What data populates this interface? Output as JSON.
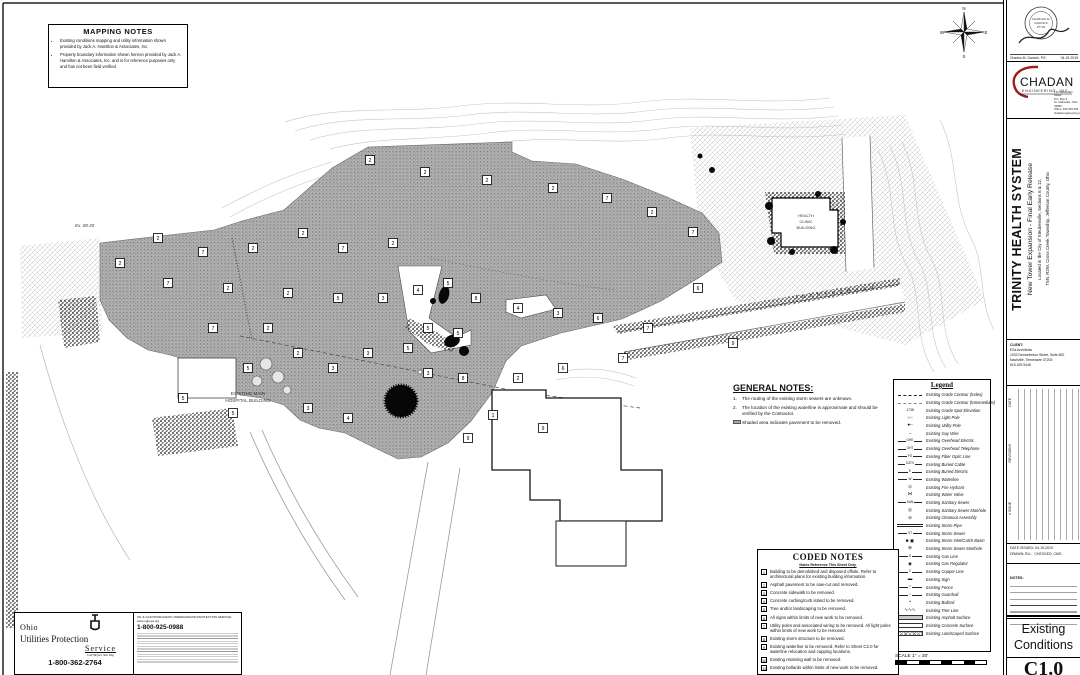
{
  "mapping_notes": {
    "title": "MAPPING NOTES",
    "items": [
      "Existing conditions mapping and utility information shown provided by Jack A. Hamilton & Associates, Inc.",
      "Property boundary information shown hereon provided by Jack A. Hamilton & Associates, Inc. and is for reference purposes only and has not been field verified."
    ]
  },
  "general_notes": {
    "title": "GENERAL NOTES:",
    "items": [
      "The routing of the existing storm sewers are unknown.",
      "The location of the existing waterline is approximate and should be verified by the Contractor."
    ],
    "shaded_note": "Shaded area indicates pavement to be removed."
  },
  "coded_notes": {
    "title": "CODED NOTES",
    "subtitle": "Notes Reference This Sheet Only.",
    "items": [
      {
        "n": "1",
        "t": "Building to be demolished and disposed offsite.  Refer to architectural plans for existing building information."
      },
      {
        "n": "2",
        "t": "Asphalt pavement to be saw-cut and removed."
      },
      {
        "n": "3",
        "t": "Concrete sidewalk to be removed."
      },
      {
        "n": "4",
        "t": "Concrete curbing/curb island to be removed."
      },
      {
        "n": "5",
        "t": "Tree and/or landscaping to be removed."
      },
      {
        "n": "6",
        "t": "All signs within limits of new work to be removed."
      },
      {
        "n": "7",
        "t": "Utility poles and associated wiring to be removed. All light poles within limits of new work to be removed."
      },
      {
        "n": "8",
        "t": "Existing storm structure to be removed."
      },
      {
        "n": "9",
        "t": "Existing waterline to be removed.  Refer to Sheet C2.0 for waterline relocation and capping locations."
      },
      {
        "n": "10",
        "t": "Existing retaining wall to be removed."
      },
      {
        "n": "11",
        "t": "Existing bollards within limits of new work to be removed."
      }
    ]
  },
  "legend": {
    "title": "Legend",
    "items": [
      {
        "k": "dash",
        "t": "Existing Grade Contour (Index)"
      },
      {
        "k": "dash2",
        "t": "Existing Grade Contour (Intermediate)"
      },
      {
        "k": "spot",
        "g": "1738",
        "t": "Existing Grade Spot Elevation"
      },
      {
        "k": "glyph",
        "g": "○–",
        "t": "Existing Light Pole"
      },
      {
        "k": "glyph",
        "g": "●–",
        "t": "Existing Utility Pole"
      },
      {
        "k": "glyph",
        "g": "→",
        "t": "Existing Guy Wire"
      },
      {
        "k": "line",
        "g": "OHE",
        "t": "Existing Overhead Electric"
      },
      {
        "k": "line",
        "g": "OHT",
        "t": "Existing Overhead Telephone"
      },
      {
        "k": "line",
        "g": "FO",
        "t": "Existing Fiber Optic Line"
      },
      {
        "k": "line",
        "g": "CATV",
        "t": "Existing Buried Cable"
      },
      {
        "k": "line",
        "g": "E",
        "t": "Existing Buried Electric"
      },
      {
        "k": "line",
        "g": "W",
        "t": "Existing Waterline"
      },
      {
        "k": "glyph",
        "g": "⊙",
        "t": "Existing Fire Hydrant"
      },
      {
        "k": "glyph",
        "g": "⋈",
        "t": "Existing Water Valve"
      },
      {
        "k": "line",
        "g": "SAN",
        "t": "Existing Sanitary Sewer"
      },
      {
        "k": "glyph",
        "g": "◎",
        "t": "Existing Sanitary Sewer Manhole"
      },
      {
        "k": "glyph",
        "g": "⊘",
        "t": "Existing Cleanout Assembly"
      },
      {
        "k": "dbl",
        "t": "Existing Storm Pipe"
      },
      {
        "k": "line",
        "g": "ST",
        "t": "Existing Storm Sewer"
      },
      {
        "k": "glyph",
        "g": "■ ▣",
        "t": "Existing Storm Inlet/Catch Basin"
      },
      {
        "k": "glyph",
        "g": "⊕",
        "t": "Existing Storm Sewer Manhole"
      },
      {
        "k": "line",
        "g": "G",
        "t": "Existing Gas Line"
      },
      {
        "k": "glyph",
        "g": "◉",
        "t": "Existing Gas Regulator"
      },
      {
        "k": "line",
        "g": "C",
        "t": "Existing Copper Line"
      },
      {
        "k": "glyph",
        "g": "▬",
        "t": "Existing Sign"
      },
      {
        "k": "line",
        "g": "×",
        "t": "Existing Fence"
      },
      {
        "k": "line",
        "g": "•",
        "t": "Existing Guardrail"
      },
      {
        "k": "glyph",
        "g": "•",
        "t": "Existing Bollard"
      },
      {
        "k": "glyph",
        "g": "∿∿∿",
        "t": "Existing Tree Line"
      },
      {
        "k": "swatch-a",
        "t": "Existing Asphalt Surface"
      },
      {
        "k": "swatch-c",
        "t": "Existing Concrete Surface"
      },
      {
        "k": "swatch-l",
        "t": "Existing Landscaped Surface"
      }
    ]
  },
  "scale": {
    "label": "SCALE 1\" = 30'"
  },
  "oups": {
    "brand1": "Ohio",
    "brand2": "Utilities Protection",
    "brand3": "Service",
    "tagline": "Call Before You Dig",
    "phone": "1-800-362-2764",
    "right_heading": "OIL & GAS PRODUCERS UNDERGROUND PROTECTION SERVICE: www.ogpups.org",
    "right_phone": "1-800-925-0988"
  },
  "map": {
    "labels": {
      "road": "J o h n s o n   R o a d",
      "clinic1": "HEALTH",
      "clinic2": "CLINIC",
      "clinic3": "BUILDING",
      "hospital1": "EXISTING MAIN",
      "hospital2": "HOSPITAL BUILDING",
      "ex_ref": "Ex. 08-20"
    },
    "compass": {
      "n": "N",
      "e": "E",
      "s": "S",
      "w": "W"
    },
    "boxes": [
      [
        370,
        160,
        "2"
      ],
      [
        425,
        172,
        "2"
      ],
      [
        487,
        180,
        "2"
      ],
      [
        553,
        188,
        "2"
      ],
      [
        607,
        198,
        "7"
      ],
      [
        652,
        212,
        "2"
      ],
      [
        693,
        232,
        "7"
      ],
      [
        158,
        238,
        "2"
      ],
      [
        203,
        252,
        "7"
      ],
      [
        253,
        248,
        "2"
      ],
      [
        303,
        233,
        "2"
      ],
      [
        343,
        248,
        "7"
      ],
      [
        393,
        243,
        "2"
      ],
      [
        120,
        263,
        "2"
      ],
      [
        168,
        283,
        "7"
      ],
      [
        228,
        288,
        "2"
      ],
      [
        288,
        293,
        "2"
      ],
      [
        338,
        298,
        "5"
      ],
      [
        383,
        298,
        "3"
      ],
      [
        418,
        290,
        "4"
      ],
      [
        448,
        283,
        "5"
      ],
      [
        476,
        298,
        "8"
      ],
      [
        518,
        308,
        "4"
      ],
      [
        558,
        313,
        "3"
      ],
      [
        598,
        318,
        "6"
      ],
      [
        428,
        328,
        "5"
      ],
      [
        458,
        333,
        "5"
      ],
      [
        408,
        348,
        "5"
      ],
      [
        368,
        353,
        "3"
      ],
      [
        298,
        353,
        "2"
      ],
      [
        333,
        368,
        "3"
      ],
      [
        428,
        373,
        "3"
      ],
      [
        463,
        378,
        "8"
      ],
      [
        518,
        378,
        "2"
      ],
      [
        543,
        428,
        "9"
      ],
      [
        468,
        438,
        "9"
      ],
      [
        348,
        418,
        "4"
      ],
      [
        248,
        368,
        "5"
      ],
      [
        213,
        328,
        "7"
      ],
      [
        268,
        328,
        "2"
      ],
      [
        698,
        288,
        "6"
      ],
      [
        648,
        328,
        "7"
      ],
      [
        733,
        343,
        "9"
      ],
      [
        233,
        413,
        "5"
      ],
      [
        183,
        398,
        "5"
      ],
      [
        308,
        408,
        "3"
      ],
      [
        493,
        415,
        "1"
      ],
      [
        563,
        368,
        "6"
      ],
      [
        623,
        358,
        "7"
      ]
    ]
  },
  "titleblock": {
    "seal": {
      "seal_name": "CHARLES M.",
      "seal_name2": "GARVICK",
      "seal_num": "#7734",
      "name_line": "Charles M. Garvick, P.E.",
      "date": "04-19-2019"
    },
    "firm": {
      "name": "CHADAN",
      "tagline": "ENGINEERING, INC.",
      "address": [
        "171 West Main Street",
        "P.O. Box 9",
        "St. Clairsville, Ohio 43950",
        "Office: 304.545.545",
        "chadanengineering.net"
      ]
    },
    "project": {
      "title": "TRINITY HEALTH SYSTEM",
      "subtitle": "New Tower Expansion - Final Early Release",
      "location1": "Located in the City of Steubenville, Sections 6 & 12,",
      "location2": "T6N, R2W, Cross Creek Township, Jefferson County, Ohio"
    },
    "client": {
      "label": "CLIENT:",
      "lines": [
        "ESa Architects",
        "1033 Demonbreun Street, Suite 800",
        "Nashville, Tennessee 37203",
        "615.329.9445"
      ]
    },
    "revisions": {
      "col1": "DATE",
      "col2": "REVISIONS",
      "col3": "# ISSUE"
    },
    "issued": {
      "date": "DATE ISSUED: 04-19-2019",
      "drawn": "DRAWN: RLL",
      "checked": "CHECKED: CMG"
    },
    "notes_label": "NOTES:",
    "sheet_title_1": "Existing",
    "sheet_title_2": "Conditions",
    "sheet_number": "C1.0"
  }
}
